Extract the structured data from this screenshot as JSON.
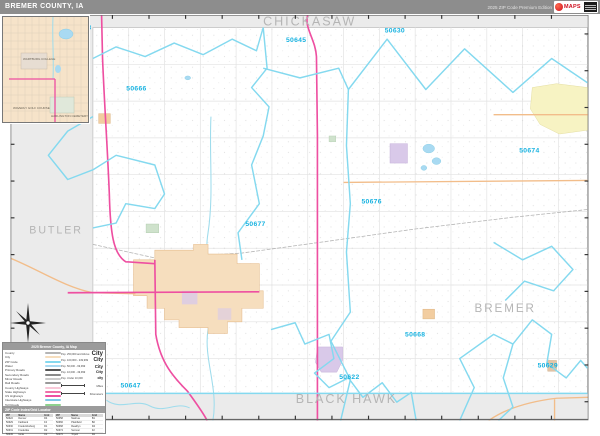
{
  "header": {
    "title": "BREMER COUNTY, IA",
    "edition": "2025 ZIP Code Premium Edition",
    "logo_text": "MAPS"
  },
  "colors": {
    "header_bg": "#8d8d8d",
    "outside_county": "#ebebeb",
    "zip_boundary": "#84d9ef",
    "zip_label": "#17b2e0",
    "county_label": "#b5b5b5",
    "highway_pink": "#ee4fa1",
    "road_orange": "#f2bd8a",
    "water": "#a9daf2",
    "city_tan": "#f6debe",
    "city_lavender": "#d9c9e9",
    "city_yellow": "#f7f3c3",
    "city_green": "#cfe2cc"
  },
  "map": {
    "county_labels": [
      {
        "text": "CHICKASAW",
        "x": 310,
        "y": 26,
        "size": 13,
        "spacing": 3
      },
      {
        "text": "BUTLER",
        "x": 48,
        "y": 241,
        "size": 11,
        "spacing": 2
      },
      {
        "text": "BREMER",
        "x": 512,
        "y": 322,
        "size": 12,
        "spacing": 2
      },
      {
        "text": "BLACK HAWK",
        "x": 348,
        "y": 416,
        "size": 13,
        "spacing": 2
      }
    ],
    "zip_labels": [
      {
        "code": "50658",
        "x": 74,
        "y": 30
      },
      {
        "code": "50645",
        "x": 296,
        "y": 43
      },
      {
        "code": "50630",
        "x": 398,
        "y": 33
      },
      {
        "code": "50666",
        "x": 131,
        "y": 93
      },
      {
        "code": "50674",
        "x": 537,
        "y": 157
      },
      {
        "code": "50676",
        "x": 374,
        "y": 210
      },
      {
        "code": "50677",
        "x": 254,
        "y": 233
      },
      {
        "code": "50668",
        "x": 419,
        "y": 347
      },
      {
        "code": "50622",
        "x": 351,
        "y": 391
      },
      {
        "code": "50629",
        "x": 556,
        "y": 379
      },
      {
        "code": "50647",
        "x": 125,
        "y": 400
      }
    ],
    "inset_labels": {
      "college": "WARTBURG COLLEGE",
      "golf": "WAVERLY GOLF COURSE",
      "cemetery": "HARLINGTON CEMETERY"
    }
  },
  "legend": {
    "title": "2025 Bremer County, IA Map",
    "items": [
      {
        "label": "County",
        "color": "#b5b5b5"
      },
      {
        "label": "City",
        "color": "#f6debe"
      },
      {
        "label": "ZIP Code",
        "color": "#84d9ef"
      },
      {
        "label": "Water",
        "color": "#a9daf2"
      },
      {
        "label": "Primary Roads",
        "color": "#555555"
      },
      {
        "label": "Secondary Roads",
        "color": "#8a8a8a"
      },
      {
        "label": "Minor Roads",
        "color": "#cccccc"
      },
      {
        "label": "Rail Roads",
        "color": "#9a9a9a"
      },
      {
        "label": "County Highways",
        "color": "#f8c8d8"
      },
      {
        "label": "State Highways",
        "color": "#f06eaa"
      },
      {
        "label": "US Highways",
        "color": "#ee4fa1"
      },
      {
        "label": "Interstate Highways",
        "color": "#7fc9e8"
      },
      {
        "label": "Toll Roads",
        "color": "#8ed18e"
      }
    ],
    "population_classes": [
      {
        "range": "Pop. 250,000 and Above",
        "sample": "City",
        "size": 6
      },
      {
        "range": "Pop. 100,000 - 249,999",
        "sample": "City",
        "size": 5
      },
      {
        "range": "Pop. 50,000 - 99,999",
        "sample": "City",
        "size": 4.4
      },
      {
        "range": "Pop. 10,000 - 49,999",
        "sample": "City",
        "size": 3.8
      },
      {
        "range": "Pop. Under 10,000",
        "sample": "city",
        "size": 3.2
      }
    ],
    "scale": {
      "miles_label": "Miles",
      "km_label": "Kilometers"
    },
    "index": {
      "title": "ZIP Code Index/Grid Locator",
      "columns": [
        "ZIP",
        "Name",
        "Grid"
      ],
      "entries": [
        {
          "zip": "50622",
          "name": "Denver",
          "grid": "D4"
        },
        {
          "zip": "50629",
          "name": "Fairbank",
          "grid": "F4"
        },
        {
          "zip": "50630",
          "name": "Fredericksburg",
          "grid": "D1"
        },
        {
          "zip": "50631",
          "name": "Frederika",
          "grid": "D2"
        },
        {
          "zip": "50645",
          "name": "Ionia",
          "grid": "C1"
        },
        {
          "zip": "50647",
          "name": "Janesville",
          "grid": "B5"
        },
        {
          "zip": "50658",
          "name": "Nashua",
          "grid": "B1"
        },
        {
          "zip": "50666",
          "name": "Plainfield",
          "grid": "B2"
        },
        {
          "zip": "50668",
          "name": "Readlyn",
          "grid": "D4"
        },
        {
          "zip": "50674",
          "name": "Sumner",
          "grid": "F2"
        },
        {
          "zip": "50676",
          "name": "Tripoli",
          "grid": "D2"
        },
        {
          "zip": "50677",
          "name": "Waverly",
          "grid": "C3"
        }
      ]
    }
  }
}
